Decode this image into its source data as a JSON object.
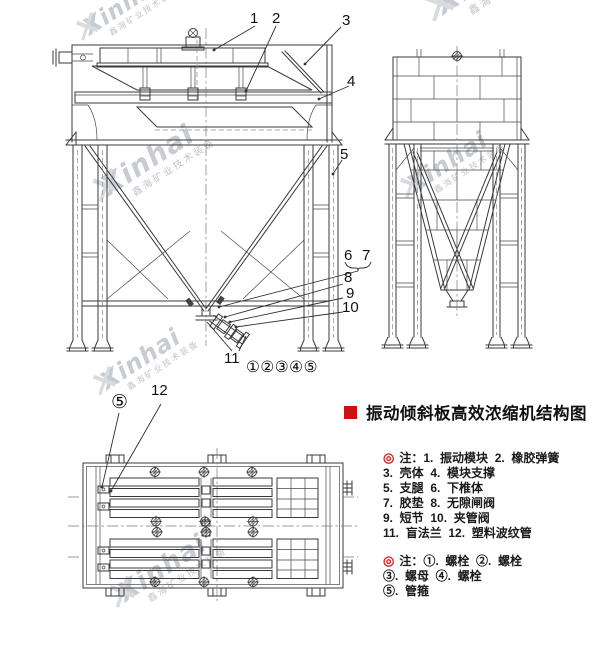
{
  "title": {
    "text": "振动倾斜板高效浓缩机结构图",
    "bullet_color": "#cc1111"
  },
  "watermark": {
    "name": "Xinhai",
    "subtitle": "鑫海矿业技术装备"
  },
  "callouts": {
    "front": [
      "1",
      "2",
      "3",
      "4",
      "5",
      "6",
      "7",
      "8",
      "9",
      "10",
      "11"
    ],
    "bolt_row": "①②③④⑤",
    "plan_clamp": "⑤",
    "plan_pipe": "12"
  },
  "notes": [
    {
      "marker": "◎",
      "lines": [
        "注：1.  振动模块  2.  橡胶弹簧",
        "3.  壳体  4.  模块支撑",
        "5.  支腿  6.  下椎体",
        "7.  胶垫  8.  无隙闸阀",
        "9.  短节  10.  夹管阀",
        "11.  盲法兰  12.  塑料波纹管"
      ]
    },
    {
      "marker": "◎",
      "lines": [
        "注：①.  螺栓  ②.  螺栓",
        "③.  螺母  ④.  螺栓",
        "⑤.  管箍"
      ]
    }
  ],
  "colors": {
    "line": "#3a3a3a",
    "accent_red": "#cc1111",
    "note_marker_red": "#cc2222",
    "watermark_gray": "#c9cdd4"
  }
}
